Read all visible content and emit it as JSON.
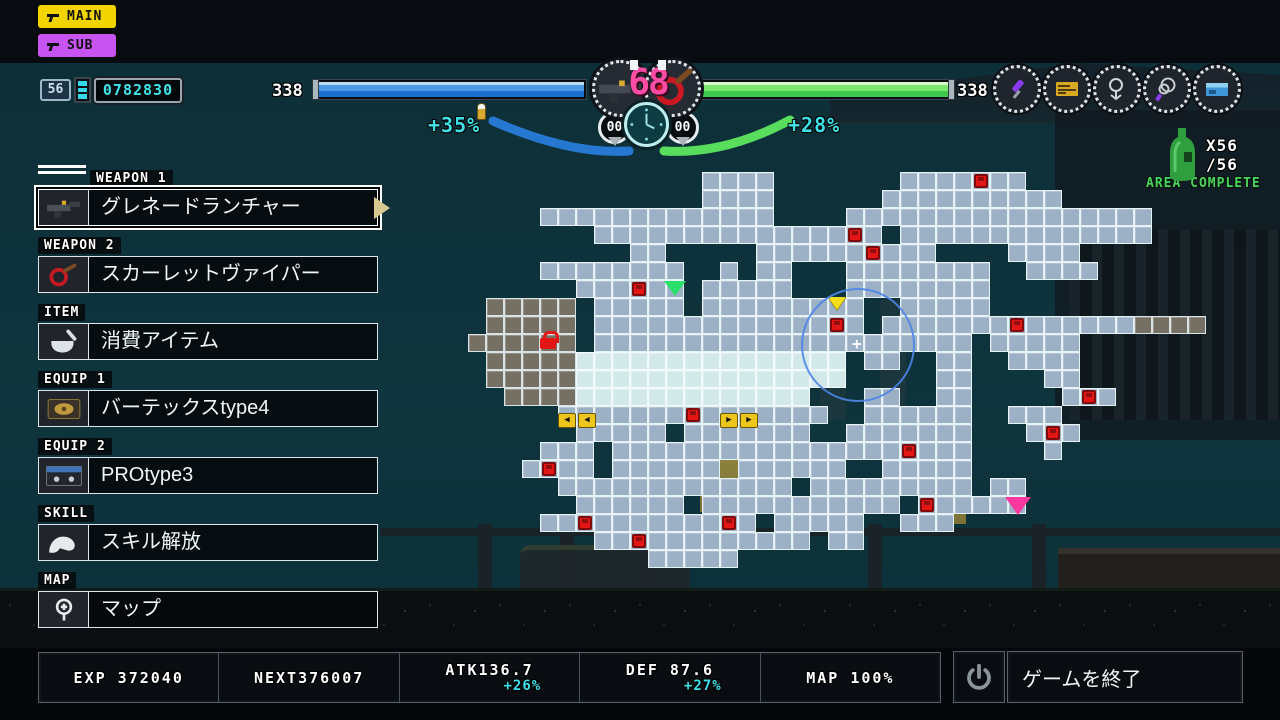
{
  "mode_buttons": {
    "main": "MAIN",
    "sub": "SUB"
  },
  "player": {
    "level": "56",
    "credits": "0782830"
  },
  "hp": {
    "left_value": "338",
    "right_value": "338"
  },
  "center_hud": {
    "combo": "68",
    "left_counter": "00",
    "right_counter": "00",
    "left_buff": "+35%",
    "right_buff": "+28%"
  },
  "hud_icons": [
    {
      "name": "kunai-icon"
    },
    {
      "name": "pass-ticket-icon"
    },
    {
      "name": "grapple-hook-icon"
    },
    {
      "name": "whip-rope-icon"
    },
    {
      "name": "blue-card-icon"
    }
  ],
  "area": {
    "bottle_count": "X56",
    "bottle_total": "/56",
    "status": "AREA COMPLETE",
    "status_color": "#4ad45c"
  },
  "menu": {
    "items": [
      {
        "label": "WEAPON 1",
        "value": "グレネードランチャー",
        "icon": "grenade-launcher-icon",
        "selected": true
      },
      {
        "label": "WEAPON 2",
        "value": "スカーレットヴァイパー",
        "icon": "scarlet-whip-icon",
        "selected": false
      },
      {
        "label": "ITEM",
        "value": "消費アイテム",
        "icon": "mortar-icon",
        "selected": false
      },
      {
        "label": "EQUIP 1",
        "value": "バーテックスtype4",
        "icon": "module-icon",
        "selected": false
      },
      {
        "label": "EQUIP 2",
        "value": "PROtype3",
        "icon": "cassette-icon",
        "selected": false
      },
      {
        "label": "SKILL",
        "value": "スキル解放",
        "icon": "arm-icon",
        "selected": false
      },
      {
        "label": "MAP",
        "value": "マップ",
        "icon": "map-pin-icon",
        "selected": false
      }
    ]
  },
  "stats": {
    "cells": [
      {
        "text": "EXP 372040"
      },
      {
        "text": "NEXT376007"
      },
      {
        "text": "ATK136.7",
        "bonus": "+26%"
      },
      {
        "text": "DEF 87.6",
        "bonus": "+27%"
      },
      {
        "text": "MAP 100%"
      }
    ]
  },
  "quit": {
    "label": "ゲームを終了"
  },
  "colors": {
    "hp_blue": "#1b6fd0",
    "hp_green": "#3cc84a",
    "accent_cyan": "#3fe0e8",
    "combo_pink": "#ff4da6",
    "main_yellow": "#f2d400",
    "sub_purple": "#c653f2",
    "save_red": "#e31515",
    "room_blue": "#9cb0c6",
    "room_cyan": "#d3e9e9",
    "room_gray": "#756f64"
  },
  "map": {
    "cell": 18,
    "left": 414,
    "top": 172,
    "legend": {
      "a": "room-visited",
      "c": "room-highlight",
      "g": "room-other-area",
      ".": "empty"
    },
    "rows": [
      "................aaaa.......aaaaaaa..........",
      "................aaaa......aaaaaaaaaa........",
      ".......aaaaaaaaaaaaa....aaaaaaaaaaaaaaaaa...",
      "..........aaaaaaaaaaaaaaaa.aaaaaaaaaaaaaa...",
      "............aa.....aaaaaaaaaa....aaaa.......",
      ".......aaaaaaaa..a.aa...aaaaaaaa..aaaa......",
      ".........aaaaaa.aaaaa...aaaaaaaa............",
      "....ggggg.aaaaa.aaaaaaaaa..aaaaa............",
      "....ggggg.aaaaaaaaaaaaaaa.aaaaaaaaaaaaaagggg",
      "...gggggg.aaaaaaaaaaaaaaaaaaaaa.aaaaa.......",
      "....gggggccccccccccccccc.aa..aa..aaaa.......",
      "....gggggccccccccccccccc.....aa....aa.......",
      ".....ggggccccccccccccc...aa..aa.....aaa.....",
      "........aaaaaaaaaaaaaaa..aaaaaa..aaa........",
      ".........aaaaa.aaaaaaa..aaaaaaa...aaa.......",
      ".......aaa.aaaaaaaaaaaaaaaaaaaa....a........",
      "......aaaa.aaaaaa.aaaaaa..aaaaa.............",
      "........aaaaaaaaaaaaa.aaaaaaaaa.aa..........",
      ".........aaaaaa.aaaaaaaaaaa.aaaaaa..........",
      ".......aaaaaaaaaaaa.aaaaa..aaa..............",
      "..........aaaaaaaaaaaa.aa...................",
      ".............aaaaa.........................."
    ],
    "markers": [
      {
        "type": "save",
        "col": 31,
        "row": 0
      },
      {
        "type": "save",
        "col": 24,
        "row": 3
      },
      {
        "type": "save",
        "col": 25,
        "row": 4
      },
      {
        "type": "save",
        "col": 12,
        "row": 6
      },
      {
        "type": "save",
        "col": 33,
        "row": 8
      },
      {
        "type": "save",
        "col": 23,
        "row": 8
      },
      {
        "type": "save",
        "col": 37,
        "row": 12
      },
      {
        "type": "save",
        "col": 15,
        "row": 13
      },
      {
        "type": "save",
        "col": 35,
        "row": 14
      },
      {
        "type": "save",
        "col": 27,
        "row": 15
      },
      {
        "type": "save",
        "col": 7,
        "row": 16
      },
      {
        "type": "save",
        "col": 28,
        "row": 18
      },
      {
        "type": "save",
        "col": 9,
        "row": 19
      },
      {
        "type": "save",
        "col": 17,
        "row": 19
      },
      {
        "type": "save",
        "col": 12,
        "row": 20
      },
      {
        "type": "lock",
        "col": 7,
        "row": 9
      },
      {
        "type": "green-flag",
        "col": 14,
        "row": 6
      },
      {
        "type": "player",
        "col": 23,
        "row": 7
      },
      {
        "type": "pink-flag",
        "col": 33,
        "row": 18
      },
      {
        "type": "transit-left",
        "col": 8,
        "row": 13,
        "glyph": "◀"
      },
      {
        "type": "transit-right",
        "col": 17,
        "row": 13,
        "glyph": "▶"
      }
    ],
    "radar": {
      "cx": 858,
      "cy": 345,
      "r": 57
    }
  }
}
